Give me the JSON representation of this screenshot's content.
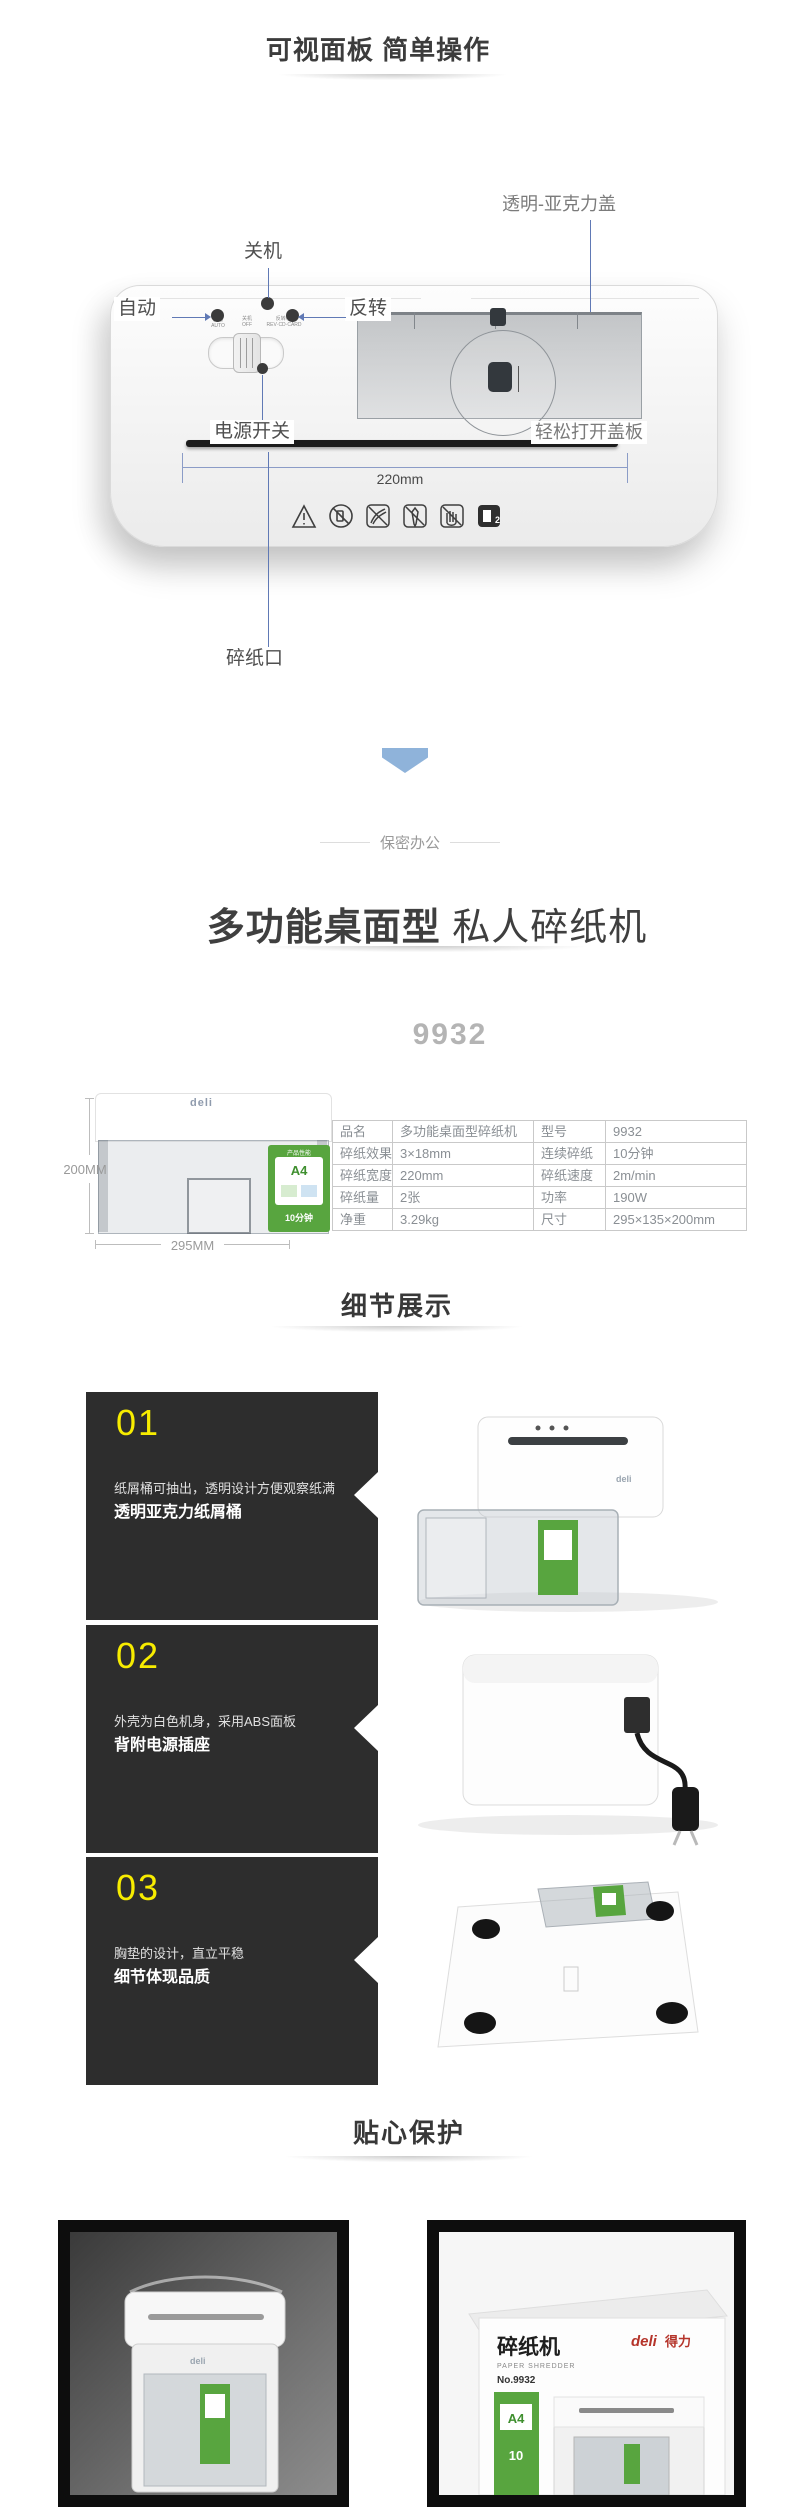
{
  "header": {
    "title": "可视面板 简单操作"
  },
  "diagram": {
    "callout_acrylic_cover": "透明-亚克力盖",
    "callout_off": "关机",
    "callout_auto": "自动",
    "callout_reverse": "反转",
    "callout_power_switch": "电源开关",
    "callout_open_cover": "轻松打开盖板",
    "callout_paper_slot": "碎纸口",
    "dim_width": "220mm",
    "panel_print": {
      "auto_cn": "自动",
      "auto_en": "AUTO",
      "off_cn": "关机",
      "off_en": "OFF",
      "rev_cn": "反转/光",
      "rev_en": "REV·CD·CARD"
    }
  },
  "divider": {
    "label": "保密办公"
  },
  "intro": {
    "title_strong": "多功能桌面型",
    "title_rest": " 私人碎纸机",
    "model": "9932"
  },
  "product": {
    "brand": "deli",
    "dim_height": "200MM",
    "dim_width": "295MM",
    "sticker_title": "产品性能",
    "sticker_a4": "A4",
    "sticker_minutes": "10分钟"
  },
  "spec_table": {
    "rows": [
      [
        "品名",
        "多功能桌面型碎纸机",
        "型号",
        "9932"
      ],
      [
        "碎纸效果",
        "3×18mm",
        "连续碎纸",
        "10分钟"
      ],
      [
        "碎纸宽度",
        "220mm",
        "碎纸速度",
        "2m/min"
      ],
      [
        "碎纸量",
        "2张",
        "功率",
        "190W"
      ],
      [
        "净重",
        "3.29kg",
        "尺寸",
        "295×135×200mm"
      ]
    ]
  },
  "details": {
    "heading": "细节展示",
    "items": [
      {
        "num": "01",
        "line1": "纸屑桶可抽出，透明设计方便观察纸满",
        "line2": "透明亚克力纸屑桶"
      },
      {
        "num": "02",
        "line1": "外壳为白色机身，采用ABS面板",
        "line2": "背附电源插座"
      },
      {
        "num": "03",
        "line1": "胸垫的设计，直立平稳",
        "line2": "细节体现品质"
      }
    ]
  },
  "protection": {
    "heading": "贴心保护"
  },
  "retail_box": {
    "name": "碎纸机",
    "sub": "PAPER SHREDDER",
    "model": "No.9932",
    "brand_en": "deli",
    "brand_cn": "得力",
    "a4": "A4",
    "cap": "10"
  },
  "colors": {
    "accent_blue": "#6079b5",
    "chevron_blue": "#8fb3da",
    "number_yellow": "#f7ec00",
    "deli_red": "#b5342a",
    "sticker_green": "#58a53f"
  }
}
